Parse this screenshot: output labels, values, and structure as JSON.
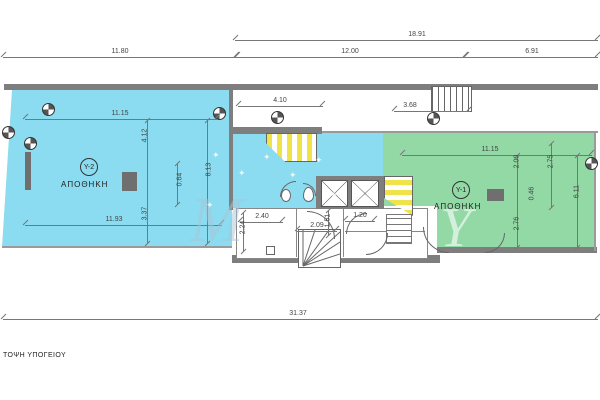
{
  "drawing": {
    "caption": "ΤΟΨΗ ΥΠΟΓΕΙΟΥ",
    "rooms": [
      {
        "code": "Υ-2",
        "label": "ΑΠΟΘΗΚΗ"
      },
      {
        "code": "Υ-1",
        "label": "ΑΠΟΘΗΚΗ"
      }
    ],
    "colors": {
      "room_y2_fill": "#8bdcf0",
      "room_y1_fill": "#93d9a6",
      "stair_fill": "#f0e34a",
      "wall_gray": "#7e7e7e"
    },
    "dims": {
      "d18_91": "18.91",
      "d11_80": "11.80",
      "d12_00": "12.00",
      "d6_91": "6.91",
      "d31_37": "31.37",
      "d11_15_a": "11.15",
      "d11_93": "11.93",
      "d4_12": "4.12",
      "d0_64": "0.64",
      "d8_13": "8.13",
      "d3_37": "3.37",
      "d4_10": "4.10",
      "d3_68": "3.68",
      "d2_40": "2.40",
      "d2_09": "2.09",
      "d1_20": "1.20",
      "d2_24": "2.24",
      "d1_51": "1.51",
      "d11_15_b": "11.15",
      "d2_00": "2.00",
      "d0_46": "0.46",
      "d2_76": "2.76",
      "d2_75": "2.75",
      "d6_11": "6.11"
    },
    "watermark": {
      "letter_m": "M",
      "letter_y": "Y",
      "star": "✦"
    }
  }
}
